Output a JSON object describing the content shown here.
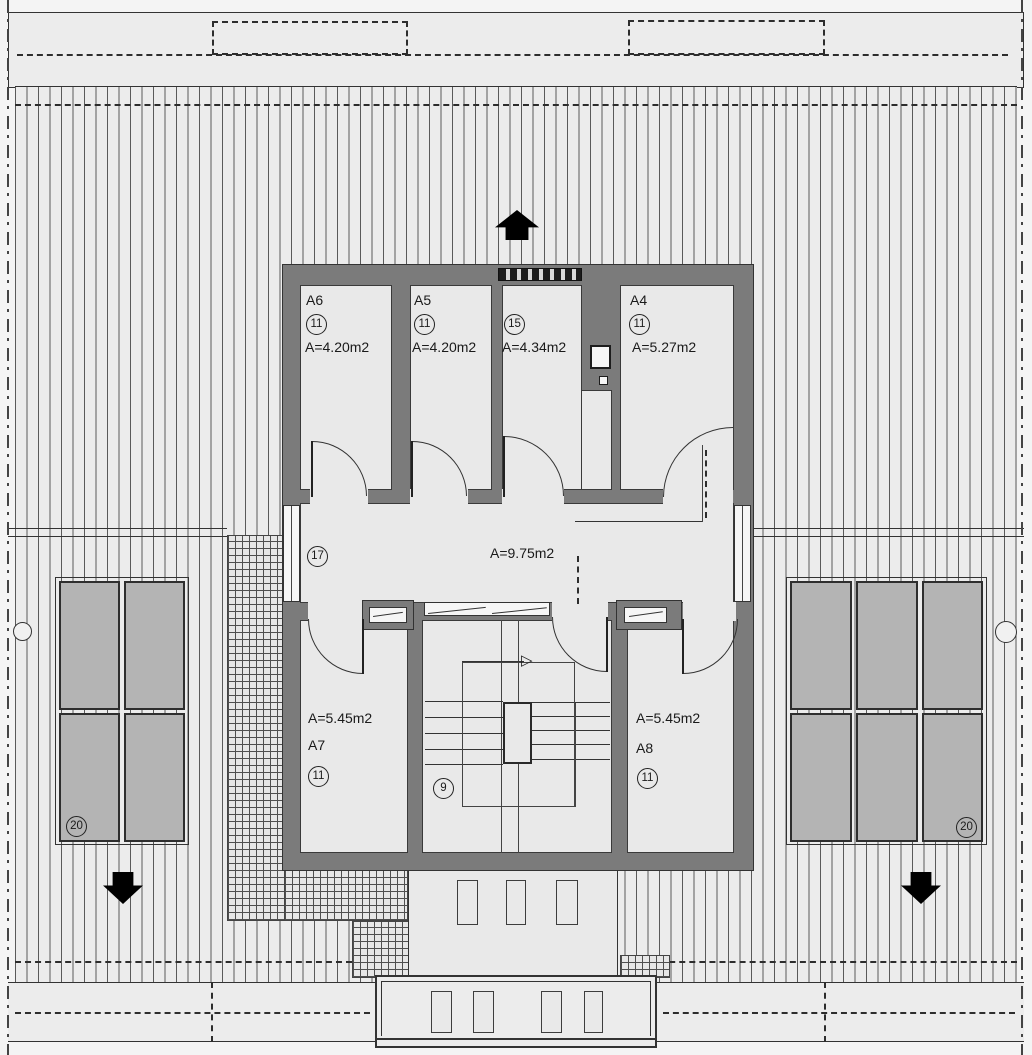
{
  "title": "attic-floor-plan",
  "colors": {
    "wall": "#7b7b7b",
    "room": "#e9e9e9",
    "roof": "#ececec",
    "panel": "#b4b4b4",
    "line": "#333333",
    "ink": "#1a1a1a",
    "arrow": "#000000",
    "page": "#f4f4f4"
  },
  "rooms": [
    {
      "key": "a6",
      "name": "A6",
      "tag": "11",
      "area": "A=4.20m2"
    },
    {
      "key": "a5",
      "name": "A5",
      "tag": "11",
      "area": "A=4.20m2"
    },
    {
      "key": "r15",
      "name": "",
      "tag": "15",
      "area": "A=4.34m2"
    },
    {
      "key": "a4",
      "name": "A4",
      "tag": "11",
      "area": "A=5.27m2"
    },
    {
      "key": "hall",
      "name": "",
      "tag": "17",
      "area": "A=9.75m2"
    },
    {
      "key": "a7",
      "name": "A7",
      "tag": "11",
      "area": "A=5.45m2"
    },
    {
      "key": "stair",
      "name": "",
      "tag": "9",
      "area": ""
    },
    {
      "key": "a8",
      "name": "A8",
      "tag": "11",
      "area": "A=5.45m2"
    }
  ],
  "roof_arrays": {
    "left": {
      "tag": "20",
      "panels": 4
    },
    "right": {
      "tag": "20",
      "panels": 6
    }
  }
}
